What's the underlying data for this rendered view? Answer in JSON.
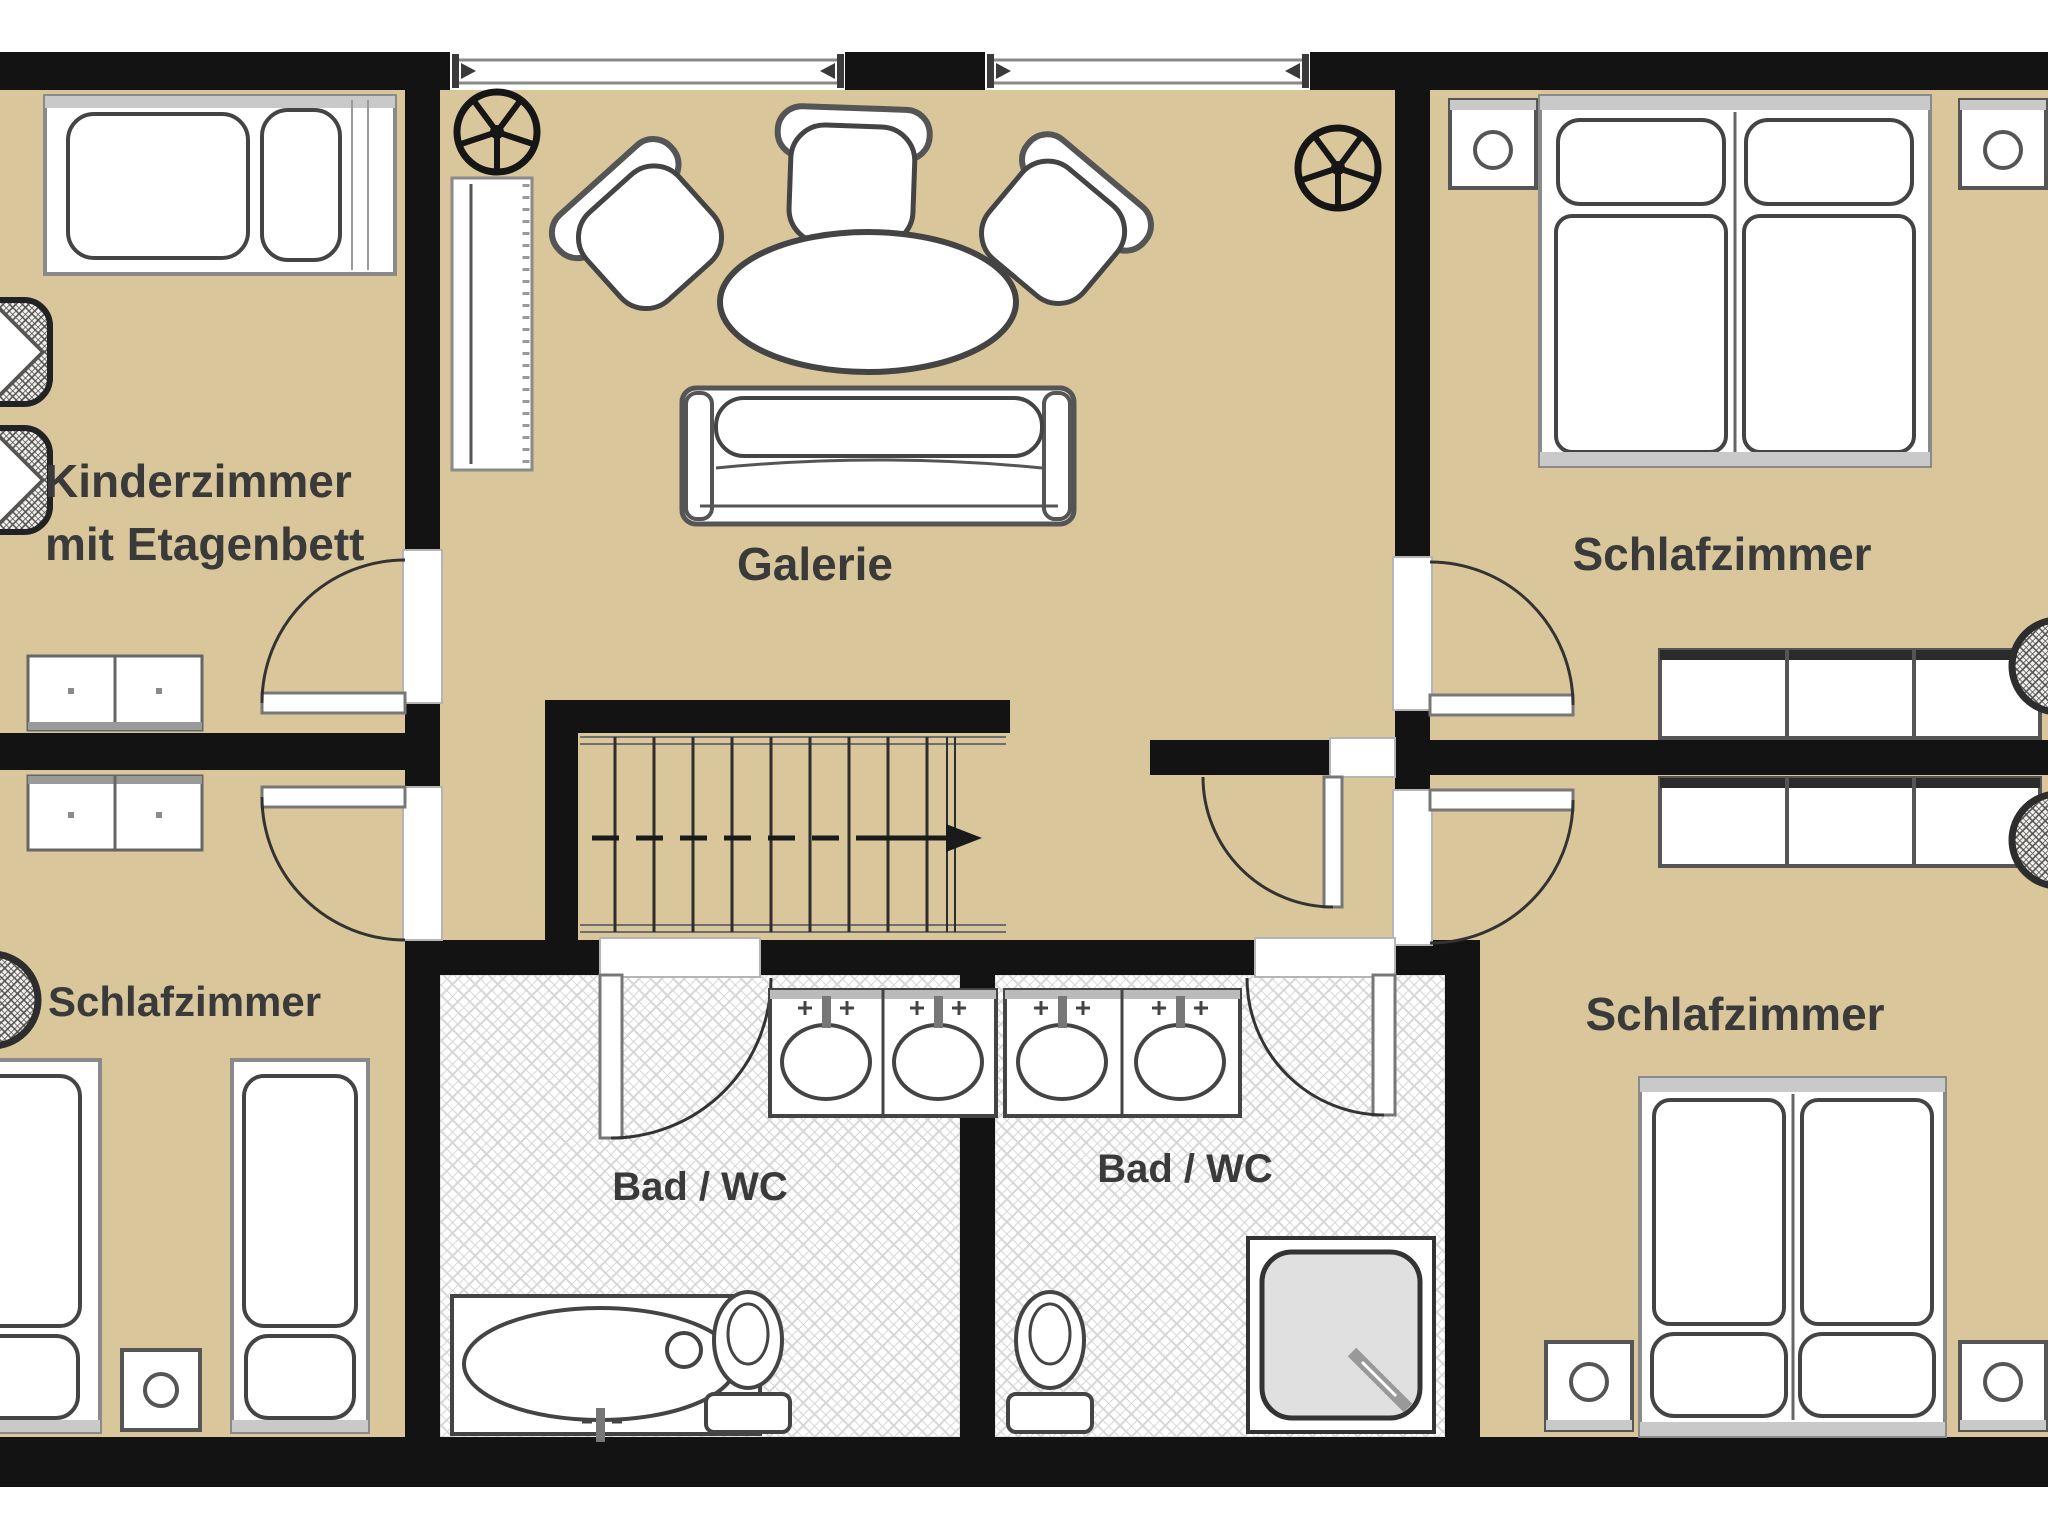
{
  "plan": {
    "type": "floor-plan",
    "language": "de",
    "labels": {
      "kinderzimmer_line1": "Kinderzimmer",
      "kinderzimmer_line2": "mit Etagenbett",
      "galerie": "Galerie",
      "schlafzimmer_top_right": "Schlafzimmer",
      "schlafzimmer_bottom_left": "Schlafzimmer",
      "schlafzimmer_bottom_right": "Schlafzimmer",
      "bad_wc_left": "Bad / WC",
      "bad_wc_right": "Bad / WC"
    },
    "colors": {
      "floor_beige": "#d9c79b",
      "wall_black": "#131313",
      "bath_floor": "#ffffff",
      "bath_hatch_line": "#d7d7d7",
      "furniture_stroke": "#4a4a4a",
      "frame_gray": "#9a9a9a",
      "band_gray": "#c9c9c9",
      "text_gray": "#3a3a3a"
    },
    "icons": [
      "ceiling-fan-icon",
      "window-icon",
      "door-swing-icon",
      "stairs-direction-arrow-icon",
      "bunk-bed-icon",
      "single-bed-icon",
      "double-bed-icon",
      "nightstand-icon",
      "dresser-icon",
      "wardrobe-icon",
      "armchair-icon",
      "sofa-icon",
      "coffee-table-icon",
      "shelf-icon",
      "washbasin-icon",
      "bathtub-icon",
      "toilet-icon",
      "shower-icon",
      "plant-icon"
    ]
  }
}
